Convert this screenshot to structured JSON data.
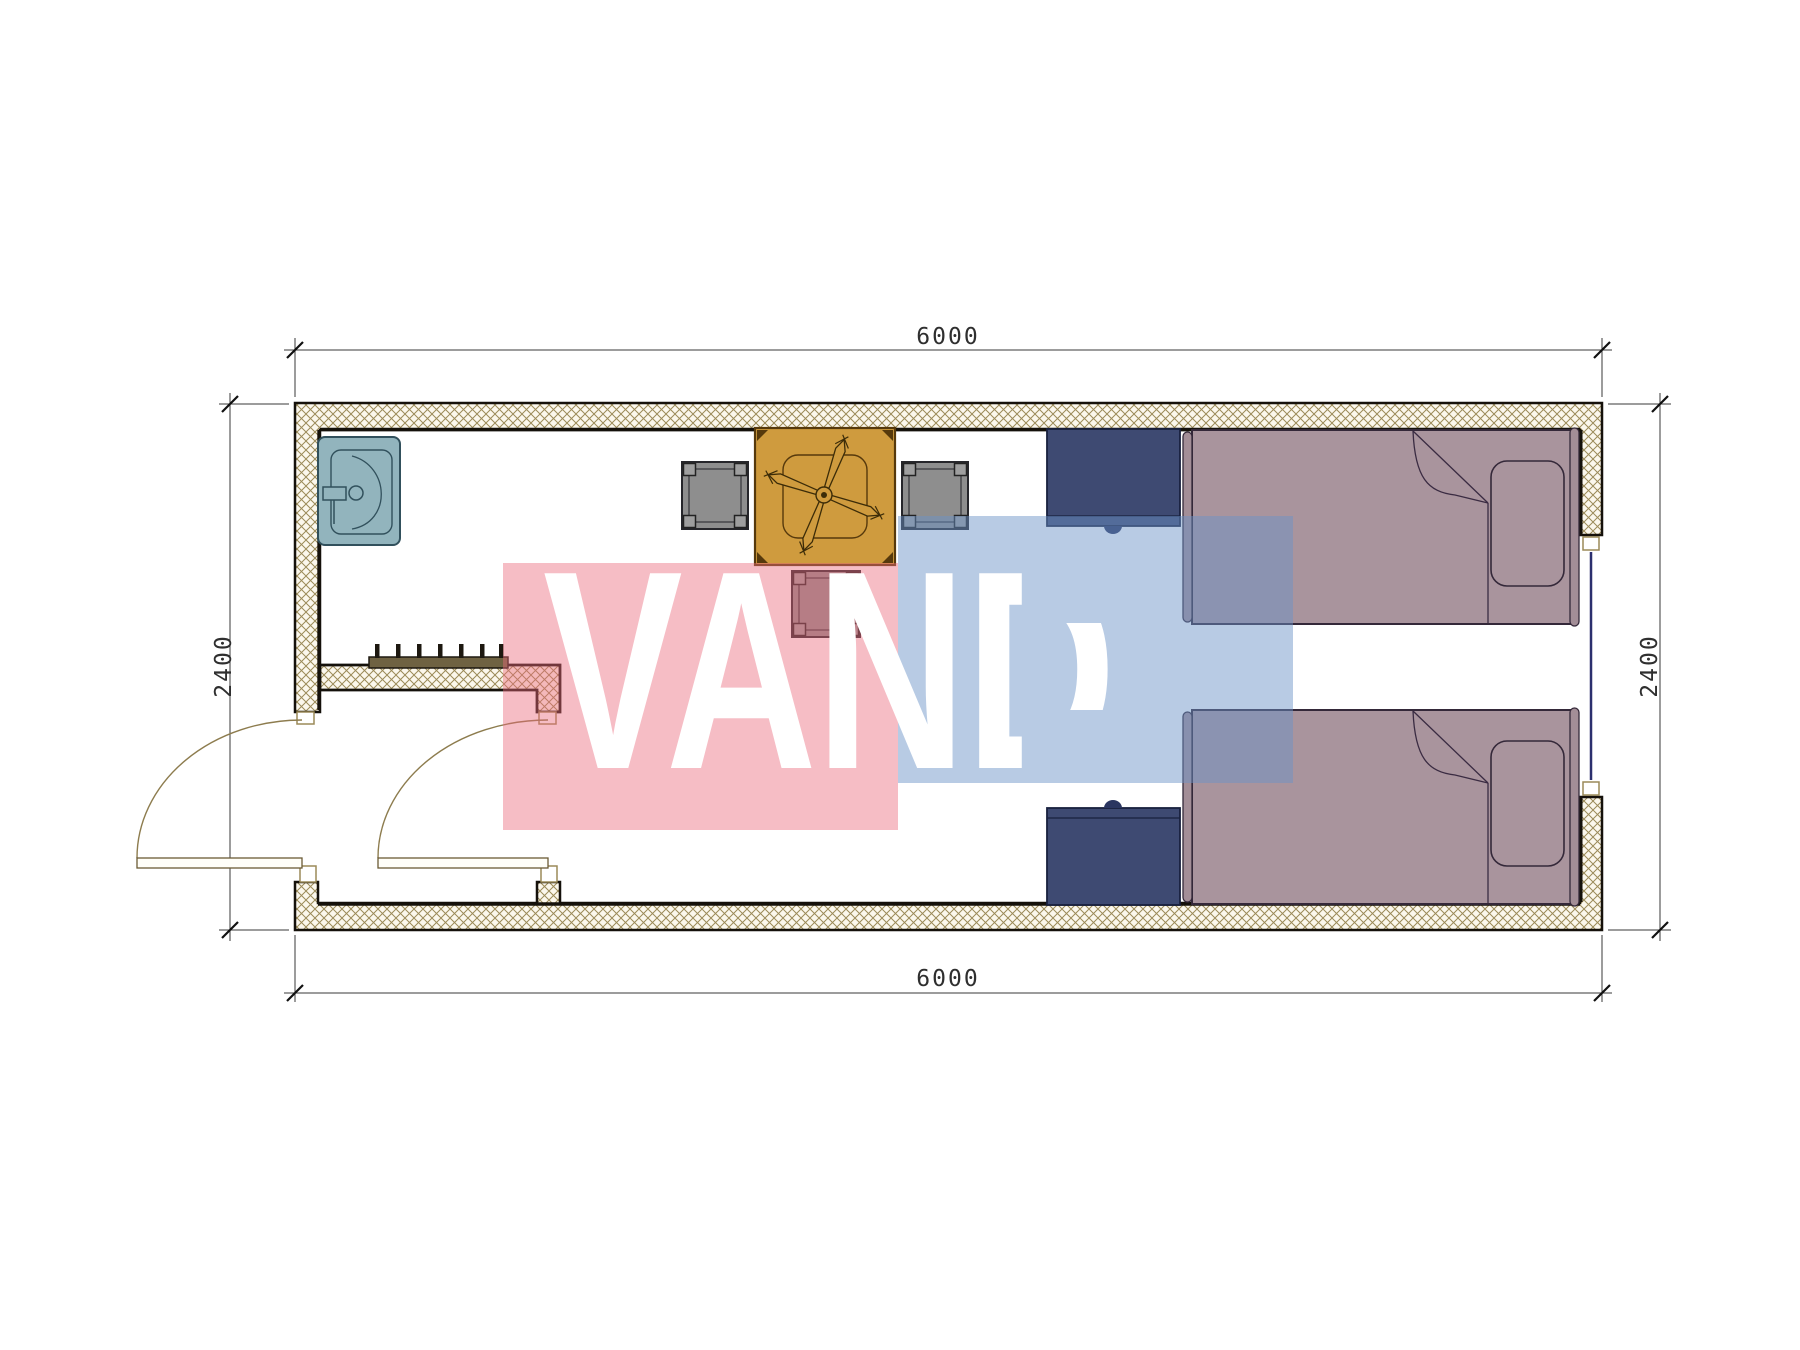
{
  "drawing": {
    "type": "architectural-floor-plan",
    "subject": "single-room container unit with vestibule, twin beds, dining table and sink"
  },
  "dimensions": {
    "top_width_mm": "6000",
    "bottom_width_mm": "6000",
    "left_height_mm": "2400",
    "right_height_mm": "2400"
  },
  "watermark": {
    "text": "VANDA",
    "text_color": "#ffffff",
    "pink_color": "#eb687c",
    "blue_color": "#6a92c6"
  },
  "colors": {
    "wall_outline": "#15110b",
    "wall_hatch": "#9b8a58",
    "wall_fill": "#fbf7ec",
    "sink": "#92b4bd",
    "table": "#cf9b3e",
    "chair": "#8e8e8e",
    "bed": "#a9949d",
    "nightstand": "#3e4a72",
    "window_glass": "#2b2f6e",
    "door_arc": "#8d7c4e",
    "dimension_line": "#3a3a3a"
  },
  "icons": [
    {
      "name": "sink-icon",
      "meaning": "wash basin with faucet"
    },
    {
      "name": "coat-rack-icon",
      "meaning": "wall hook rail in vestibule"
    },
    {
      "name": "dining-table-icon",
      "meaning": "square table with ceiling fan symbol"
    },
    {
      "name": "chair-icon",
      "meaning": "square chair, three around table"
    },
    {
      "name": "bed-icon",
      "meaning": "single bed with pillow and folded blanket, two units"
    },
    {
      "name": "nightstand-icon",
      "meaning": "navy bedside cabinet with knob, two units"
    },
    {
      "name": "door-icon",
      "meaning": "swing door leaf with quarter-circle arc, two units"
    },
    {
      "name": "window-icon",
      "meaning": "glazing line on right wall"
    }
  ]
}
